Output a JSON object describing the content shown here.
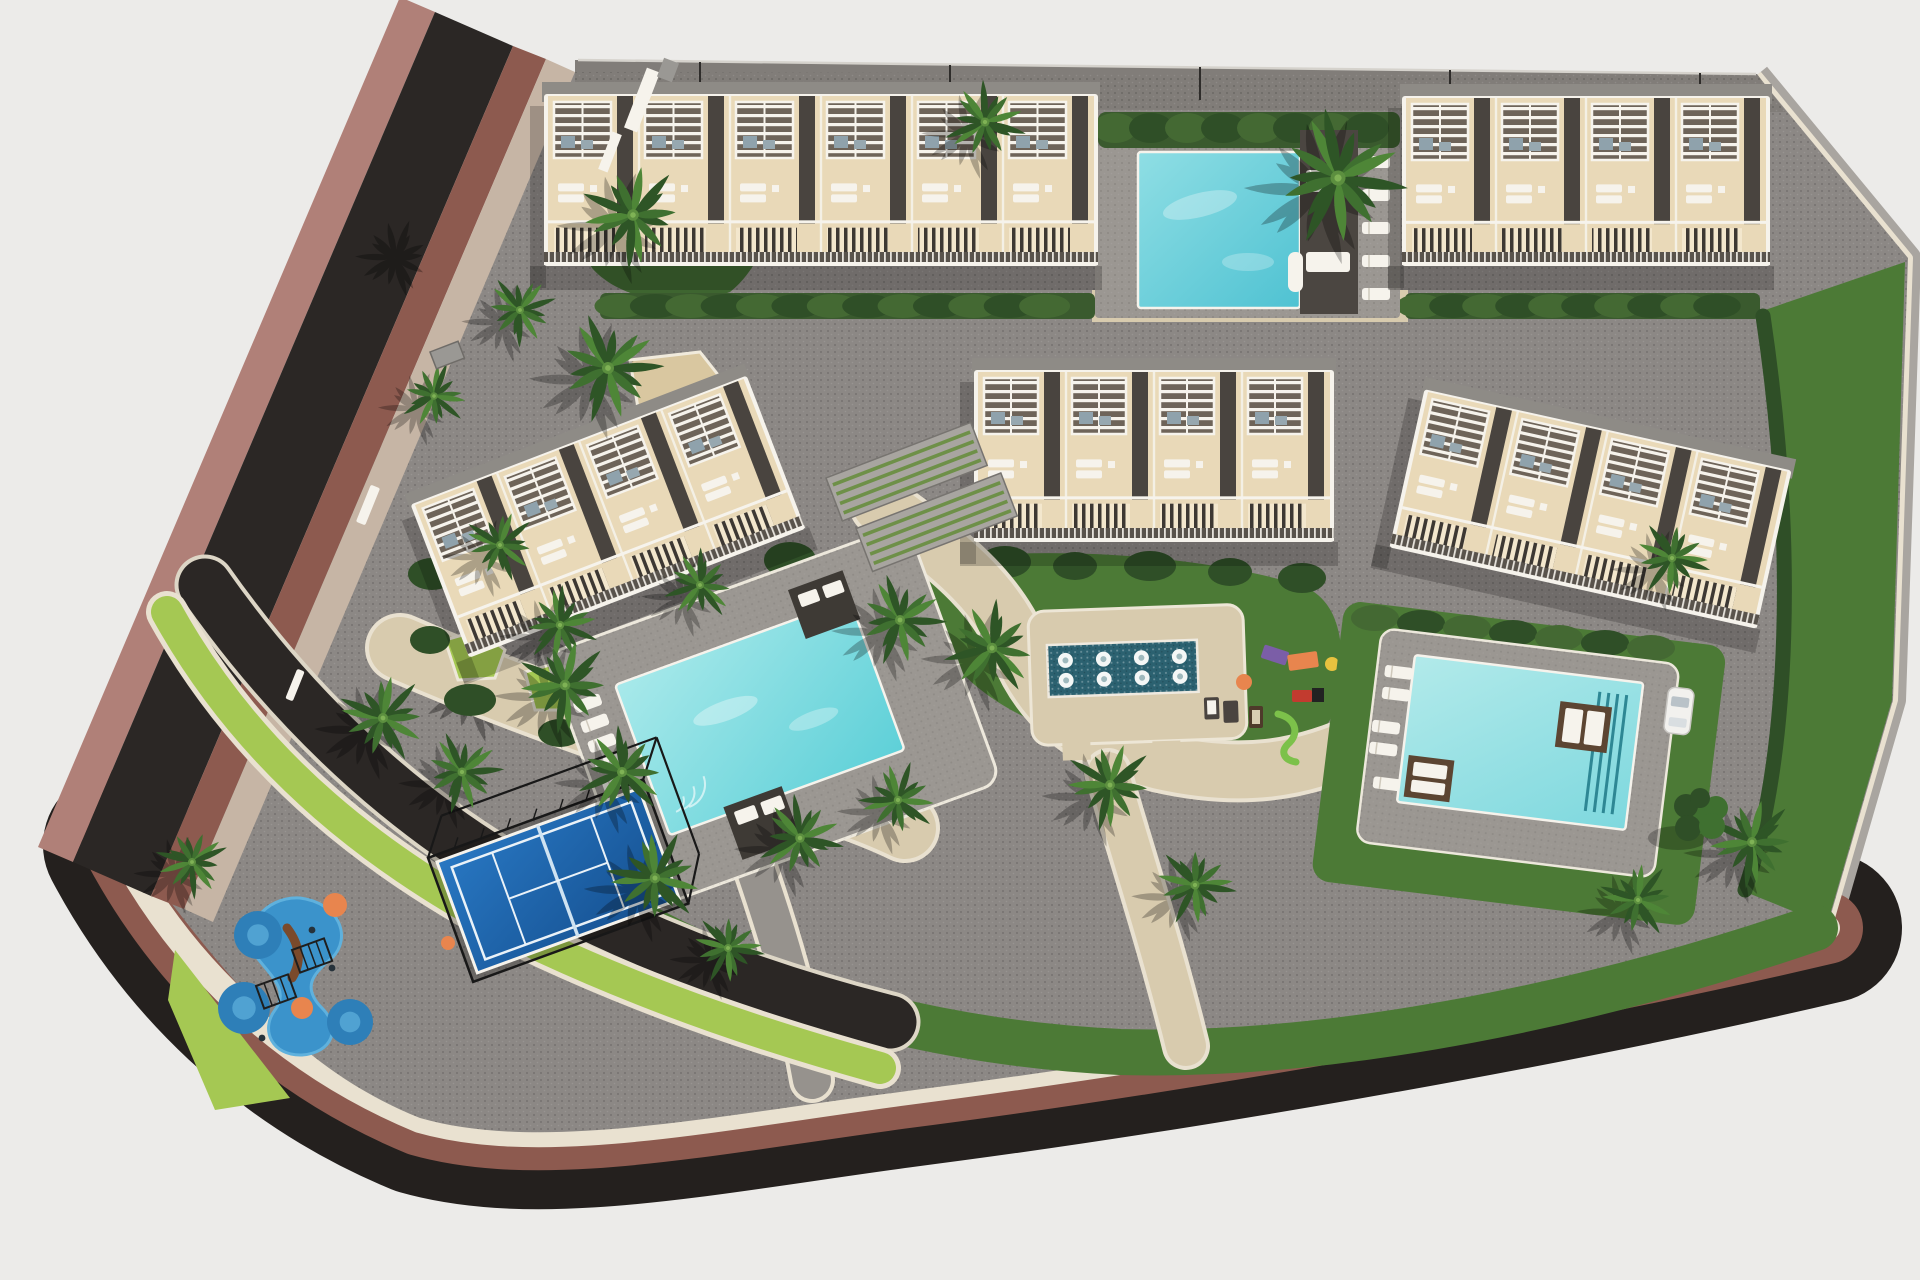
{
  "meta": {
    "type": "architectural-aerial-3d-render",
    "subject": "residential development site plan",
    "image_width": 1920,
    "image_height": 1280
  },
  "scene": {
    "roads": [
      {
        "id": "street-west",
        "surface": "dark asphalt",
        "edges": "red-brown sidewalk strips"
      },
      {
        "id": "street-south",
        "surface": "dark asphalt",
        "edges": "red-brown sidewalk with cream curb"
      },
      {
        "id": "internal-driveway",
        "surface": "dark asphalt",
        "edges": "lime lawn verge with white curbs"
      }
    ],
    "buildings": [
      {
        "id": "building-north-west",
        "type": "townhouse-row",
        "roof_terraces": 6,
        "features": [
          "white pergolas",
          "roof sun loungers",
          "stair wells",
          "white balconies"
        ]
      },
      {
        "id": "building-north-east",
        "type": "townhouse-row",
        "roof_terraces": 4,
        "features": [
          "white pergolas",
          "roof sun loungers",
          "stair wells",
          "white balconies"
        ]
      },
      {
        "id": "building-west",
        "type": "townhouse-row",
        "roof_terraces": 4,
        "rotation_deg": -21,
        "features": [
          "white pergolas",
          "roof sun loungers"
        ]
      },
      {
        "id": "building-central",
        "type": "townhouse-row",
        "roof_terraces": 4,
        "features": [
          "white pergolas",
          "roof sun loungers",
          "white balconies"
        ]
      },
      {
        "id": "building-east",
        "type": "townhouse-row",
        "roof_terraces": 4,
        "rotation_deg": 12.5,
        "features": [
          "white pergolas",
          "roof sun loungers"
        ]
      }
    ],
    "amenities": [
      {
        "id": "pool-north",
        "type": "swimming-pool",
        "water_color": "turquoise",
        "features": [
          "dark deck platform",
          "white sun loungers",
          "hedge screen"
        ]
      },
      {
        "id": "pool-main",
        "type": "swimming-pool",
        "water_color": "light turquoise",
        "sun_loungers": 8,
        "shade_pergolas": 2
      },
      {
        "id": "fountain-splash-pool",
        "type": "water-feature",
        "fountain_jets": 8,
        "water_color": "deep teal"
      },
      {
        "id": "pool-east",
        "type": "swimming-pool",
        "water_color": "pale turquoise",
        "day_beds": 2,
        "sun_loungers": 5
      },
      {
        "id": "paddle-court",
        "type": "paddle-tennis-court",
        "surface_color": "blue",
        "enclosure": "black cage fence"
      },
      {
        "id": "splash-playground",
        "type": "kids-water-playground",
        "features": [
          "blue splash pads",
          "orange pads",
          "climbing frames",
          "arch bridge"
        ]
      },
      {
        "id": "playground",
        "type": "kids-playground",
        "features": [
          "green slide",
          "purple unit",
          "orange unit",
          "picnic table"
        ]
      }
    ],
    "landscaping": {
      "palm_trees": 25,
      "hedge_rows": 5,
      "lawn_areas": 6,
      "planting_beds": 4,
      "shade_tree": 1
    },
    "vehicles": [
      {
        "id": "parked-car",
        "color": "white"
      }
    ]
  },
  "palette": {
    "bg": "#ECEBE9",
    "asphalt": "#2B2725",
    "asphaltDeep": "#24201E",
    "maroon": "#8D5A4F",
    "maroonLight": "#B08078",
    "walk": "#C6B5A5",
    "curb": "#E9E1D0",
    "site": "#8C8885",
    "siteDark": "#817D79",
    "deck": "#9B9792",
    "beige": "#E9D9B8",
    "beigeLight": "#F3E7CD",
    "white": "#F6F3EC",
    "channel": "#49443F",
    "pergola": "#6E6459",
    "roofSlab": "#8E8B86",
    "balc": "#59534C",
    "hedge": "#3A5A2E",
    "hedgeDark": "#2F4F27",
    "hedgeLight": "#446933",
    "lawn": "#4C7A36",
    "lawnDark": "#3E6530",
    "lime": "#A5C853",
    "tan": "#D8CBAE",
    "sand": "#D9C7A0",
    "poolTopA": "#8FDEE4",
    "poolTopB": "#4FC2D2",
    "poolMainA": "#A8E9EA",
    "poolMainB": "#5ED0D8",
    "poolEastA": "#B2EAEA",
    "poolEastB": "#7ED8DE",
    "fountain": "#2B6170",
    "jet": "#F4F7F6",
    "courtA": "#2877C2",
    "courtB": "#154F8F",
    "fence": "#181818",
    "splash": "#3B93CB",
    "splashDeep": "#2E7FB8",
    "orange": "#E8854E",
    "purple": "#7B5EA7",
    "red": "#C23B2F",
    "slide": "#7CC14A",
    "palmDark": "#2E5526",
    "palmMid": "#3F7030",
    "palmLight": "#4E8637",
    "palmCore": "#5C8F3F",
    "brown": "#5C4532",
    "darkStruct": "#3E3A35",
    "furn": "#8FA2AC",
    "steel": "#9A9894",
    "shadow": "rgba(0,0,0,0.20)"
  }
}
